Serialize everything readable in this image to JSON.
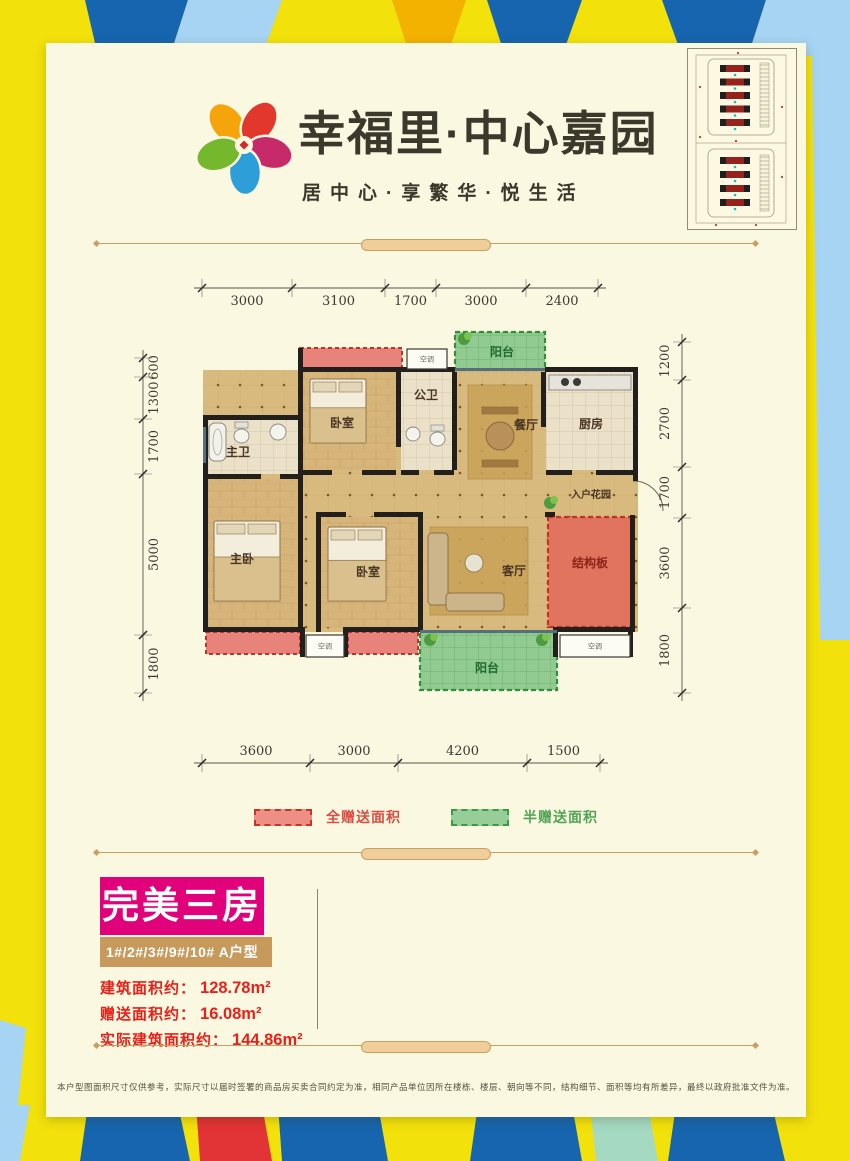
{
  "colors": {
    "border_yellow": "#F3E10B",
    "border_dark_blue": "#1765AE",
    "border_light_blue": "#A6D4F2",
    "border_gold": "#F3B200",
    "border_red": "#E23336",
    "border_teal": "#A5D9C2",
    "card_bg": "#FBF8E1",
    "brand_text": "#3B382C",
    "accent_magenta": "#E1017B",
    "accent_tan": "#C79A5B",
    "area_text_red": "#E8211A",
    "gift_full_red": "#C6352A",
    "gift_half_green": "#3C9A47",
    "wall_black": "#221F1C",
    "wood_floor": "#D7B57A",
    "tile_floor": "#EBE1C8"
  },
  "header": {
    "title": "幸福里·中心嘉园",
    "subtitle": "居中心·享繁华·悦生活"
  },
  "site_plan": {
    "north_rows": 5,
    "south_rows": 4
  },
  "floorplan": {
    "ac_label": "空调",
    "rooms": [
      {
        "id": "interior",
        "label": "",
        "x": 73,
        "y": 95,
        "w": 435,
        "h": 262,
        "floor": "dots"
      },
      {
        "id": "balcony-top",
        "label": "阳台",
        "x": 325,
        "y": 57,
        "w": 90,
        "h": 38,
        "floor": "half",
        "lx": 372,
        "ly": 81
      },
      {
        "id": "bedroom-top",
        "label": "卧室",
        "x": 173,
        "y": 97,
        "w": 93,
        "h": 98,
        "floor": "wood",
        "lx": 212,
        "ly": 152
      },
      {
        "id": "bath-public",
        "label": "公卫",
        "x": 271,
        "y": 97,
        "w": 51,
        "h": 98,
        "floor": "tile",
        "lx": 296,
        "ly": 124
      },
      {
        "id": "dining",
        "label": "餐厅",
        "x": 327,
        "y": 97,
        "w": 84,
        "h": 116,
        "floor": "dots",
        "lx": 396,
        "ly": 154
      },
      {
        "id": "kitchen",
        "label": "厨房",
        "x": 416,
        "y": 97,
        "w": 87,
        "h": 98,
        "floor": "tile",
        "lx": 461,
        "ly": 153
      },
      {
        "id": "bath-master",
        "label": "主卫",
        "x": 78,
        "y": 145,
        "w": 90,
        "h": 54,
        "floor": "tile",
        "lx": 108,
        "ly": 181
      },
      {
        "id": "entry-garden",
        "label": "入户花园",
        "x": 416,
        "y": 200,
        "w": 87,
        "h": 37,
        "floor": "dots",
        "lx": 461,
        "ly": 223
      },
      {
        "id": "master-bedroom",
        "label": "主卧",
        "x": 78,
        "y": 204,
        "w": 90,
        "h": 148,
        "floor": "wood",
        "lx": 112,
        "ly": 288
      },
      {
        "id": "bedroom-2",
        "label": "卧室",
        "x": 191,
        "y": 242,
        "w": 97,
        "h": 110,
        "floor": "wood",
        "lx": 238,
        "ly": 301
      },
      {
        "id": "living",
        "label": "客厅",
        "x": 293,
        "y": 242,
        "w": 122,
        "h": 110,
        "floor": "dots",
        "lx": 384,
        "ly": 300
      },
      {
        "id": "structural",
        "label": "结构板",
        "x": 418,
        "y": 242,
        "w": 84,
        "h": 110,
        "floor": "full",
        "lx": 460,
        "ly": 292
      },
      {
        "id": "balcony-bottom",
        "label": "阳台",
        "x": 290,
        "y": 357,
        "w": 137,
        "h": 58,
        "floor": "half",
        "lx": 357,
        "ly": 397
      }
    ],
    "gift_zones": [
      {
        "x": 170,
        "y": 73,
        "w": 102,
        "h": 22
      },
      {
        "x": 76,
        "y": 357,
        "w": 94,
        "h": 22
      },
      {
        "x": 218,
        "y": 357,
        "w": 70,
        "h": 22
      }
    ],
    "walls": [
      [
        170,
        92,
        155,
        5
      ],
      [
        415,
        92,
        93,
        5
      ],
      [
        168,
        73,
        5,
        124
      ],
      [
        73,
        140,
        97,
        5
      ],
      [
        73,
        140,
        5,
        217
      ],
      [
        73,
        352,
        100,
        5
      ],
      [
        215,
        352,
        78,
        5
      ],
      [
        427,
        352,
        76,
        5
      ],
      [
        266,
        97,
        5,
        75
      ],
      [
        322,
        97,
        5,
        98
      ],
      [
        411,
        97,
        5,
        55
      ],
      [
        503,
        92,
        5,
        114
      ],
      [
        500,
        240,
        5,
        117
      ],
      [
        168,
        195,
        34,
        5
      ],
      [
        232,
        195,
        34,
        5
      ],
      [
        271,
        195,
        18,
        5
      ],
      [
        304,
        195,
        20,
        5
      ],
      [
        416,
        195,
        26,
        5
      ],
      [
        466,
        195,
        40,
        5
      ],
      [
        73,
        199,
        58,
        5
      ],
      [
        150,
        199,
        20,
        5
      ],
      [
        168,
        199,
        5,
        158
      ],
      [
        186,
        237,
        30,
        5
      ],
      [
        244,
        237,
        49,
        5
      ],
      [
        186,
        237,
        5,
        120
      ],
      [
        288,
        237,
        5,
        120
      ],
      [
        170,
        352,
        5,
        30
      ],
      [
        213,
        352,
        5,
        30
      ],
      [
        423,
        352,
        5,
        30
      ],
      [
        498,
        352,
        5,
        30
      ],
      [
        415,
        237,
        10,
        5
      ]
    ],
    "windows": [
      [
        325,
        93,
        90,
        3
      ],
      [
        290,
        355,
        137,
        3
      ],
      [
        73,
        152,
        3,
        36
      ]
    ],
    "ac_units": [
      [
        277,
        74,
        40,
        20
      ],
      [
        176,
        360,
        38,
        22
      ],
      [
        430,
        360,
        70,
        22
      ]
    ],
    "furniture": [
      {
        "t": "rug",
        "x": 338,
        "y": 110,
        "w": 64,
        "h": 94
      },
      {
        "t": "table",
        "x": 352,
        "y": 138,
        "w": 36,
        "h": 46
      },
      {
        "t": "bed",
        "x": 180,
        "y": 104,
        "w": 56,
        "h": 64
      },
      {
        "t": "bed",
        "x": 84,
        "y": 246,
        "w": 66,
        "h": 80
      },
      {
        "t": "bed",
        "x": 198,
        "y": 252,
        "w": 58,
        "h": 74
      },
      {
        "t": "rug",
        "x": 300,
        "y": 252,
        "w": 98,
        "h": 88
      },
      {
        "t": "sofa",
        "x": 300,
        "y": 256,
        "w": 76,
        "h": 80
      },
      {
        "t": "counter",
        "x": 419,
        "y": 100,
        "w": 82,
        "h": 15
      },
      {
        "t": "tub",
        "x": 79,
        "y": 148,
        "w": 17,
        "h": 38
      },
      {
        "t": "toilet",
        "x": 104,
        "y": 149,
        "w": 15,
        "h": 18
      },
      {
        "t": "toilet",
        "x": 300,
        "y": 152,
        "w": 15,
        "h": 18
      },
      {
        "t": "basin",
        "x": 140,
        "y": 149,
        "w": 16,
        "h": 16
      },
      {
        "t": "basin",
        "x": 276,
        "y": 152,
        "w": 14,
        "h": 14
      },
      {
        "t": "plant",
        "x": 334,
        "y": 64,
        "w": 10,
        "h": 10
      },
      {
        "t": "plant",
        "x": 420,
        "y": 228,
        "w": 9,
        "h": 9
      },
      {
        "t": "plant",
        "x": 300,
        "y": 365,
        "w": 10,
        "h": 10
      },
      {
        "t": "plant",
        "x": 412,
        "y": 365,
        "w": 10,
        "h": 10
      },
      {
        "t": "doorarc",
        "x": 503,
        "y": 206,
        "w": 30,
        "h": 30
      }
    ],
    "dims": {
      "top": {
        "orient": "h",
        "line": 13,
        "ticks": [
          72,
          162,
          255,
          306,
          396,
          468
        ],
        "values": [
          "3000",
          "3100",
          "1700",
          "3000",
          "2400"
        ],
        "label_offset": 17
      },
      "bottom": {
        "orient": "h",
        "line": 488,
        "ticks": [
          72,
          180,
          268,
          397,
          470
        ],
        "values": [
          "3600",
          "3000",
          "4200",
          "1500"
        ],
        "label_offset": -8
      },
      "left": {
        "orient": "v",
        "line": 13,
        "ticks": [
          83,
          102,
          144,
          199,
          360,
          418
        ],
        "values": [
          "600",
          "1300",
          "1700",
          "5000",
          "1800"
        ],
        "label_offset": 15
      },
      "right": {
        "orient": "v",
        "line": 552,
        "ticks": [
          67,
          105,
          192,
          243,
          333,
          418
        ],
        "values": [
          "1200",
          "2700",
          "1700",
          "3600",
          "1800"
        ],
        "label_offset": -13
      }
    }
  },
  "legend": {
    "full": {
      "label": "全赠送面积"
    },
    "half": {
      "label": "半赠送面积"
    }
  },
  "info": {
    "title": "完美三房",
    "units": "1#/2#/3#/9#/10#  A户型",
    "lines": [
      {
        "label": "建筑面积约：",
        "value": "128.78m²"
      },
      {
        "label": "赠送面积约：",
        "value": "16.08m²"
      },
      {
        "label": "实际建筑面积约：",
        "value": "144.86m²"
      }
    ]
  },
  "disclaimer": "本户型图面积尺寸仅供参考，实际尺寸以届时签署的商品房买卖合同约定为准，相同产品单位因所在楼栋、楼层、朝向等不同，结构细节、面积等均有所差异，最终以政府批准文件为准。"
}
